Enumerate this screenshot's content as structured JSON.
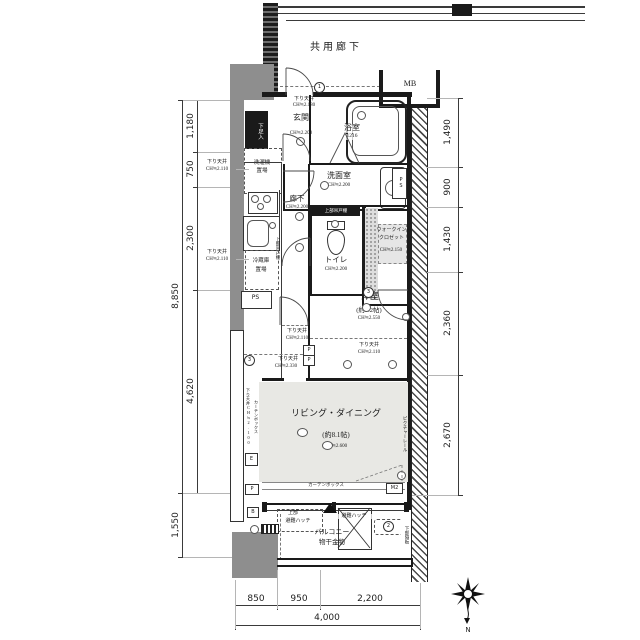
{
  "corridor": {
    "label": "共用廊下"
  },
  "mb": {
    "label": "MB"
  },
  "entrance": {
    "soffit": "下り天井",
    "soffit_ch": "CH≒2.180",
    "name": "玄関",
    "ch": "CH≒2.200",
    "shoe_box": "下足入",
    "washer1": "洗濯機",
    "washer2": "置場"
  },
  "bath": {
    "name": "浴室",
    "size": "1216"
  },
  "washroom": {
    "name": "洗面室",
    "ch": "CH≒2.200"
  },
  "hall": {
    "name": "廊下",
    "ch": "CH≒2.200"
  },
  "toilet": {
    "name": "トイレ",
    "ch": "CH≒2.200",
    "shelf": "上部吊戸棚"
  },
  "kitchen": {
    "shelf": "上部吊戸棚",
    "fridge1": "冷蔵庫",
    "fridge2": "置場",
    "ps": "PS"
  },
  "ps_right": {
    "label": "PS"
  },
  "wic": {
    "line1": "ウォークイン",
    "line2": "クロゼット",
    "ch": "CH≒2.150"
  },
  "bedroom": {
    "name": "洋室",
    "size": "(約3.2帖)",
    "ch": "CH≒2.550",
    "soffit": "下り天井",
    "soffit_ch": "CH≒2.110"
  },
  "living": {
    "name": "リビング・ダイニング",
    "size": "(約8.1帖)",
    "ch": "CH≒2.600",
    "curtain_box": "カーテンボックス",
    "picture_rail": "ピクチャーレール",
    "left_note1": "下り天井CH≒2.100",
    "left_note2": "カーテンボックス"
  },
  "soffit_callouts": {
    "a1": "下り天井",
    "a2": "CH≒2.110",
    "b1": "下り天井",
    "b2": "CH≒2.110",
    "hall1": "下り天井",
    "hall2": "CH≒2.110",
    "c1": "下り天井",
    "c2": "CH≒2.330"
  },
  "balcony": {
    "name": "バルコニー",
    "laundry": "物干金物",
    "hatch_upper1": "上部",
    "hatch_upper2": "避難ハッチ",
    "hatch": "避難ハッチ",
    "partition": "下部隔板"
  },
  "marks": {
    "m2": "M2",
    "e": "E",
    "p": "P",
    "p1": "P",
    "p2": "P",
    "b": "B",
    "c1": "1",
    "c2": "2",
    "c3": "3",
    "c3b": "3"
  },
  "dims": {
    "left_outer": [
      "8,850",
      "1,550"
    ],
    "left_inner": [
      "1,180",
      "750",
      "2,300",
      "4,620"
    ],
    "right": [
      "1,490",
      "900",
      "1,430",
      "2,360",
      "2,670"
    ],
    "bottom": [
      "850",
      "950",
      "2,200"
    ],
    "bottom_total": "4,000"
  },
  "compass": {
    "north": "N"
  }
}
